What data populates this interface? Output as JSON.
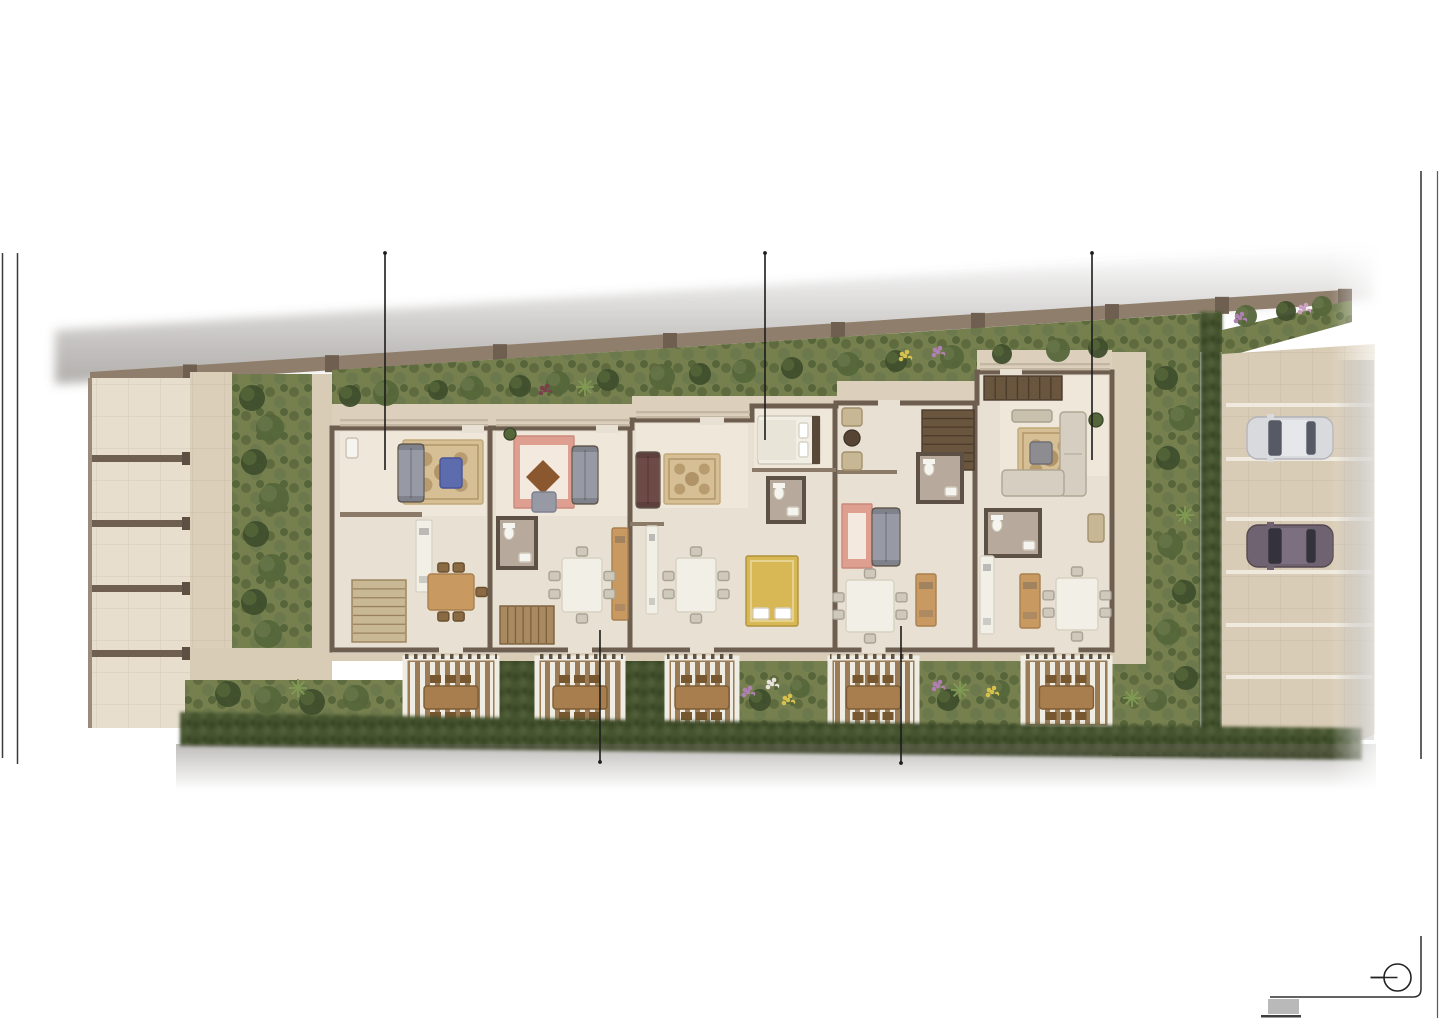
{
  "scene": {
    "kind": "architectural-site-plan-rendering",
    "view": "top-down ground floor plan of a 5-unit terraced residential building with front gardens, rear pergola terraces, left driveway stalls and right guest parking",
    "units_visible": 5,
    "cars_visible": 2,
    "pergola_terraces": 5,
    "driveway_stalls": 5
  },
  "colors": {
    "page_bg": "#ffffff",
    "floor": "#e8e0d3",
    "floor_light": "#efe8db",
    "walkway": "#dcd0bc",
    "walkway2": "#d8ccb7",
    "wall_dark": "#6e5e50",
    "wall_mid": "#8c7a69",
    "site_wall": "#8f7e6c",
    "pier": "#6f5f50",
    "stall_floor": "#e7decd",
    "lane": "#dbcfba",
    "grass": "#76804f",
    "hedge": "#45522f",
    "deck": "#9b7c57",
    "slat": "#efece3",
    "beam": "#7b6a58",
    "outdoor_table": "#a87e4e",
    "outdoor_chair": "#77572f",
    "parking": "#d9ccb6",
    "parking_line": "#f2ede2",
    "bath_wall": "#5d5045",
    "bath_floor": "#b7aa9c",
    "fixture_white": "#f6f4ee",
    "sofa_gray": "#9799a4",
    "sofa_maroon": "#6e4a47",
    "sofa_cream": "#d6cec0",
    "rug_base": "#d6bf94",
    "rug_pattern": "#b09366",
    "rug_border": "#c2a877",
    "salmon": "#df9f90",
    "salmon_light": "#f3e9de",
    "diamond_rug": "#8a572f",
    "blue_table": "#5d6cac",
    "wood": "#c89a62",
    "wood_dark": "#8a6a42",
    "bed_white": "#f1eee6",
    "bed_blanket": "#e9e4d8",
    "headboard": "#584838",
    "bed_gold": "#d8b855",
    "counter_white": "#f2efe6",
    "chair_gray": "#cfc9bb",
    "stair_light": "#c9b894",
    "stair_mid": "#a9895f",
    "stair_dark": "#6a563f",
    "callout_line": "#1c1c1c",
    "frame_line": "#2e2e2e",
    "footer_block": "#b9b9b9"
  },
  "page": {
    "left_rules": [
      {
        "x": 2.5,
        "y1": 253,
        "y2": 758
      },
      {
        "x": 17.5,
        "y1": 253,
        "y2": 764
      }
    ],
    "right_frame": {
      "inner_x": 1421,
      "outer_x": 1437.5,
      "top_y": 171,
      "break_top": 759,
      "break_bottom": 936,
      "corner_y": 997,
      "corner_r": 8,
      "h_end_x": 1270,
      "outer_bottom": 1018
    },
    "compass": {
      "cx": 1397.5,
      "cy": 977.5,
      "r": 13.5,
      "tail": 27
    },
    "footer_block": {
      "x": 1268,
      "y": 999,
      "w": 31,
      "h": 15
    },
    "footer_line": {
      "x": 1261,
      "y": 1015,
      "w": 40,
      "h": 2.5
    }
  },
  "callouts": [
    {
      "x": 385,
      "y1": 253,
      "y2": 470,
      "cap": "top"
    },
    {
      "x": 765,
      "y1": 253,
      "y2": 440,
      "cap": "top"
    },
    {
      "x": 1092,
      "y1": 253,
      "y2": 460,
      "cap": "top"
    },
    {
      "x": 600,
      "y1": 630,
      "y2": 762,
      "cap": "bottom"
    },
    {
      "x": 901,
      "y1": 626,
      "y2": 763,
      "cap": "bottom"
    }
  ],
  "site": {
    "pier_xs": [
      190,
      332,
      500,
      670,
      838,
      978,
      1112,
      1222,
      1345
    ],
    "party_wall_xs": [
      490,
      630,
      835,
      975
    ],
    "unit_fronts": [
      {
        "x1": 332,
        "x2": 632,
        "y": 428
      },
      {
        "x1": 632,
        "x2": 837,
        "y": 420
      },
      {
        "x1": 837,
        "x2": 977,
        "y": 403
      },
      {
        "x1": 977,
        "x2": 1112,
        "y": 372
      }
    ],
    "rear_wall_y": 650
  },
  "driveway": {
    "stall_divider_ys": [
      455,
      520,
      585,
      650
    ]
  },
  "parking": {
    "stall_line_ys": [
      403,
      457,
      517,
      570,
      623,
      675
    ],
    "cars": [
      {
        "name": "car-light",
        "x": 1247,
        "y": 417,
        "body": "#d9dade",
        "body2": "#e6e7ea",
        "glass": "#565a64",
        "line": "#b4b5bc"
      },
      {
        "name": "car-dark",
        "x": 1247,
        "y": 525,
        "body": "#6f6372",
        "body2": "#7c6f80",
        "glass": "#34323a",
        "line": "#55484f"
      }
    ]
  },
  "terraces": [
    {
      "x": 405,
      "w": 92
    },
    {
      "x": 537,
      "w": 86
    },
    {
      "x": 667,
      "w": 70
    },
    {
      "x": 830,
      "w": 87
    },
    {
      "x": 1023,
      "w": 87
    }
  ],
  "terrace_band": {
    "y": 658,
    "h": 70
  },
  "hedge_gaps": [
    {
      "x": 497,
      "w": 40
    },
    {
      "x": 623,
      "w": 44
    }
  ],
  "garden_gaps": [
    {
      "x": 737,
      "w": 93
    },
    {
      "x": 917,
      "w": 106
    }
  ],
  "furniture": {
    "rugs_ornate": [
      [
        403,
        440,
        80,
        64
      ],
      [
        664,
        454,
        56,
        50
      ],
      [
        1018,
        428,
        64,
        60
      ]
    ],
    "rugs_plain": [
      {
        "x": 514,
        "y": 436,
        "w": 60,
        "h": 72
      },
      {
        "x": 842,
        "y": 504,
        "w": 30,
        "h": 64
      }
    ],
    "diamond_rug": {
      "cx": 543,
      "cy": 477,
      "s": 17
    },
    "sofas": [
      {
        "x": 398,
        "y": 444,
        "w": 26,
        "h": 58,
        "c": "#9799a4"
      },
      {
        "x": 572,
        "y": 446,
        "w": 26,
        "h": 58,
        "c": "#9799a4"
      },
      {
        "x": 636,
        "y": 452,
        "w": 24,
        "h": 56,
        "c": "#6e4a47"
      },
      {
        "x": 872,
        "y": 508,
        "w": 28,
        "h": 58,
        "c": "#9799a4"
      }
    ],
    "lsofa": {
      "v": [
        1060,
        412,
        26,
        84
      ],
      "h": [
        1002,
        470,
        62,
        26
      ]
    },
    "beds": [
      {
        "x": 758,
        "y": 416,
        "w": 62,
        "h": 48,
        "type": "white"
      },
      {
        "x": 746,
        "y": 556,
        "w": 52,
        "h": 70,
        "type": "gold"
      }
    ],
    "stairs": [
      {
        "x": 352,
        "y": 580,
        "w": 54,
        "h": 62,
        "tone": "light",
        "dir": "h"
      },
      {
        "x": 500,
        "y": 606,
        "w": 54,
        "h": 38,
        "tone": "mid",
        "dir": "v"
      },
      {
        "x": 922,
        "y": 410,
        "w": 52,
        "h": 60,
        "tone": "dark",
        "dir": "h"
      },
      {
        "x": 984,
        "y": 376,
        "w": 78,
        "h": 24,
        "tone": "dark",
        "dir": "v"
      }
    ],
    "baths": [
      {
        "x": 498,
        "y": 518,
        "w": 38,
        "h": 50
      },
      {
        "x": 768,
        "y": 478,
        "w": 36,
        "h": 44
      },
      {
        "x": 918,
        "y": 454,
        "w": 44,
        "h": 48
      },
      {
        "x": 986,
        "y": 510,
        "w": 54,
        "h": 46
      }
    ],
    "counters": [
      {
        "x": 416,
        "y": 520,
        "w": 16,
        "h": 72,
        "c": "white"
      },
      {
        "x": 646,
        "y": 526,
        "w": 12,
        "h": 88,
        "c": "white"
      },
      {
        "x": 980,
        "y": 556,
        "w": 14,
        "h": 78,
        "c": "white"
      },
      {
        "x": 612,
        "y": 528,
        "w": 16,
        "h": 92,
        "c": "wood"
      },
      {
        "x": 916,
        "y": 574,
        "w": 20,
        "h": 52,
        "c": "wood"
      },
      {
        "x": 1020,
        "y": 574,
        "w": 20,
        "h": 54,
        "c": "wood"
      }
    ],
    "tables": [
      {
        "x": 562,
        "y": 558,
        "w": 40,
        "h": 54,
        "l": 2,
        "r": 2,
        "t": 1,
        "b": 1,
        "wc": false
      },
      {
        "x": 676,
        "y": 558,
        "w": 40,
        "h": 54,
        "l": 2,
        "r": 2,
        "t": 1,
        "b": 1,
        "wc": false
      },
      {
        "x": 846,
        "y": 580,
        "w": 48,
        "h": 52,
        "l": 2,
        "r": 2,
        "t": 1,
        "b": 1,
        "wc": false
      },
      {
        "x": 1056,
        "y": 578,
        "w": 42,
        "h": 52,
        "l": 2,
        "r": 2,
        "t": 1,
        "b": 1,
        "wc": false
      },
      {
        "x": 428,
        "y": 574,
        "w": 46,
        "h": 36,
        "l": 0,
        "r": 1,
        "t": 2,
        "b": 2,
        "wc": true
      }
    ],
    "shapes": [
      {
        "k": "rr",
        "x": 440,
        "y": 458,
        "w": 22,
        "h": 30,
        "f": "#5d6cac",
        "s": "#49549b",
        "n": "coffee-table-blue"
      },
      {
        "k": "rr",
        "x": 1030,
        "y": 442,
        "w": 22,
        "h": 22,
        "f": "#8d8d91",
        "s": "#6f6f75",
        "n": "coffee-table-gray"
      },
      {
        "k": "rr",
        "x": 532,
        "y": 492,
        "w": 24,
        "h": 20,
        "f": "#9799a4",
        "s": "#7e8090",
        "n": "armchair"
      },
      {
        "k": "rr",
        "x": 1012,
        "y": 410,
        "w": 40,
        "h": 12,
        "f": "#c9c0ae",
        "s": "#a9a091",
        "n": "bench"
      },
      {
        "k": "rr",
        "x": 842,
        "y": 408,
        "w": 20,
        "h": 18,
        "f": "#c7b795",
        "s": "#a4906c",
        "n": "wicker-chair"
      },
      {
        "k": "rr",
        "x": 842,
        "y": 452,
        "w": 20,
        "h": 18,
        "f": "#c7b795",
        "s": "#a4906c",
        "n": "wicker-chair"
      },
      {
        "k": "c",
        "x": 852,
        "y": 438,
        "r": 8,
        "f": "#564534",
        "s": "#3e3226",
        "n": "round-table"
      },
      {
        "k": "rr",
        "x": 1088,
        "y": 514,
        "w": 16,
        "h": 28,
        "f": "#c7b795",
        "s": "#a4906c",
        "n": "wicker-chair"
      },
      {
        "k": "c",
        "x": 510,
        "y": 434,
        "r": 6,
        "f": "#55663a",
        "s": "#39452a",
        "n": "potted-plant"
      },
      {
        "k": "c",
        "x": 1096,
        "y": 420,
        "r": 7,
        "f": "#55663a",
        "s": "#39452a",
        "n": "potted-plant"
      },
      {
        "k": "rr",
        "x": 346,
        "y": 438,
        "w": 12,
        "h": 20,
        "f": "#f6f4ee",
        "s": "#c9c2b4",
        "n": "sink"
      }
    ],
    "partitions": [
      [
        340,
        512,
        82,
        5
      ],
      [
        752,
        468,
        84,
        4
      ],
      [
        837,
        470,
        60,
        4
      ],
      [
        630,
        522,
        34,
        4
      ]
    ],
    "door_gaps": [
      [
        462,
        425,
        22,
        8
      ],
      [
        596,
        425,
        22,
        8
      ],
      [
        700,
        417,
        24,
        8
      ],
      [
        878,
        400,
        22,
        8
      ],
      [
        1000,
        369,
        22,
        8
      ]
    ],
    "beams": [
      [
        340,
        419,
        148
      ],
      [
        496,
        419,
        134
      ],
      [
        636,
        411,
        114
      ],
      [
        980,
        363,
        130
      ]
    ]
  },
  "landscape": {
    "bushes": [
      [
        350,
        396,
        11,
        1
      ],
      [
        386,
        393,
        13,
        2
      ],
      [
        438,
        390,
        10,
        1
      ],
      [
        472,
        388,
        12,
        2
      ],
      [
        520,
        386,
        11,
        1
      ],
      [
        558,
        383,
        12,
        2
      ],
      [
        608,
        380,
        11,
        1
      ],
      [
        662,
        377,
        13,
        2
      ],
      [
        700,
        374,
        11,
        1
      ],
      [
        744,
        371,
        12,
        2
      ],
      [
        792,
        368,
        11,
        1
      ],
      [
        848,
        364,
        12,
        2
      ],
      [
        896,
        361,
        11,
        1
      ],
      [
        952,
        357,
        12,
        2
      ],
      [
        1002,
        354,
        10,
        1
      ],
      [
        1058,
        350,
        12,
        2
      ],
      [
        1098,
        348,
        10,
        1
      ],
      [
        1246,
        316,
        11,
        2
      ],
      [
        1286,
        311,
        10,
        1
      ],
      [
        1322,
        306,
        10,
        2
      ],
      [
        252,
        398,
        13,
        1
      ],
      [
        270,
        428,
        14,
        2
      ],
      [
        254,
        462,
        13,
        1
      ],
      [
        274,
        498,
        15,
        2
      ],
      [
        256,
        534,
        13,
        1
      ],
      [
        272,
        568,
        14,
        2
      ],
      [
        254,
        602,
        13,
        1
      ],
      [
        268,
        634,
        14,
        2
      ],
      [
        1166,
        378,
        12,
        1
      ],
      [
        1182,
        418,
        13,
        2
      ],
      [
        1168,
        458,
        12,
        1
      ],
      [
        1170,
        545,
        13,
        2
      ],
      [
        1184,
        592,
        12,
        1
      ],
      [
        1168,
        632,
        13,
        2
      ],
      [
        1186,
        678,
        12,
        1
      ],
      [
        1156,
        700,
        11,
        2
      ],
      [
        228,
        694,
        13,
        1
      ],
      [
        268,
        700,
        14,
        2
      ],
      [
        312,
        702,
        13,
        1
      ],
      [
        356,
        698,
        13,
        2
      ],
      [
        760,
        700,
        11,
        1
      ],
      [
        800,
        688,
        10,
        2
      ],
      [
        948,
        700,
        11,
        1
      ],
      [
        1000,
        690,
        10,
        2
      ]
    ],
    "flowers": [
      [
        545,
        390,
        "#7a3f4b"
      ],
      [
        905,
        356,
        "#d6c14e"
      ],
      [
        938,
        352,
        "#b07fb3"
      ],
      [
        1240,
        318,
        "#b07fb3"
      ],
      [
        1304,
        309,
        "#c9a0c0"
      ],
      [
        748,
        692,
        "#b07fb3"
      ],
      [
        788,
        700,
        "#d6c14e"
      ],
      [
        772,
        684,
        "#e7e3da"
      ],
      [
        938,
        686,
        "#b07fb3"
      ],
      [
        992,
        692,
        "#d6c14e"
      ]
    ],
    "agaves": [
      [
        585,
        387
      ],
      [
        1185,
        515
      ],
      [
        960,
        690
      ],
      [
        1132,
        698
      ],
      [
        298,
        688
      ]
    ]
  }
}
